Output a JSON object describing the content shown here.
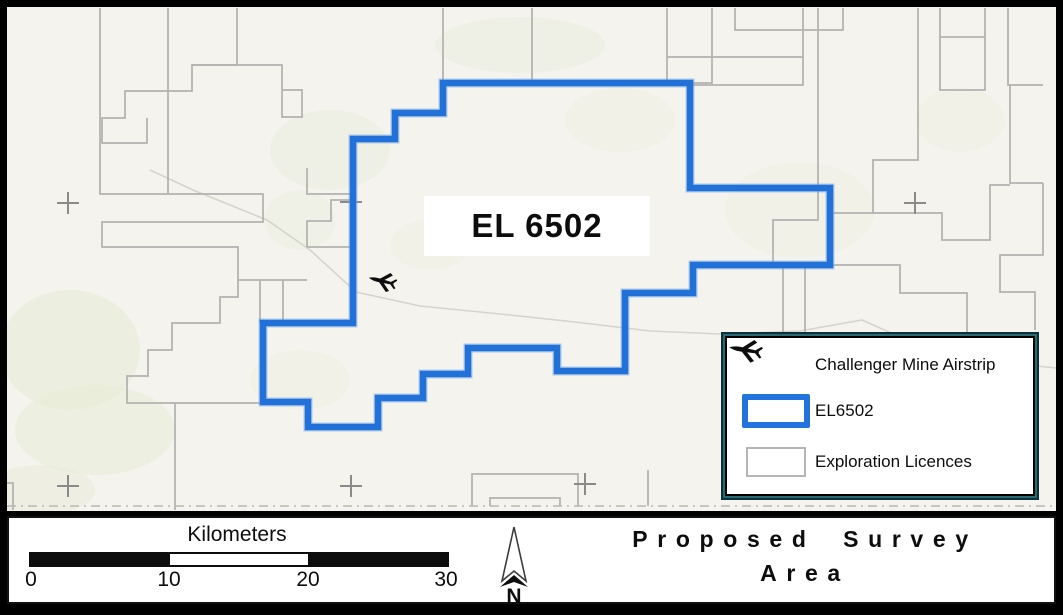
{
  "map": {
    "el_label": "EL 6502",
    "colors": {
      "background": "#f4f3ee",
      "el6502_stroke": "#2171d9",
      "el6502_halo": "#74a8e8",
      "licence_stroke": "#b3b3b1",
      "road_stroke": "#d5d4cd",
      "cross_stroke": "#8a8a8a",
      "dashed_stroke": "#b9b8b2",
      "vegetation_fill": "#e6ebd3"
    },
    "el6502_polygon": [
      [
        443,
        83
      ],
      [
        690,
        83
      ],
      [
        690,
        188
      ],
      [
        830,
        188
      ],
      [
        830,
        265
      ],
      [
        693,
        265
      ],
      [
        693,
        293
      ],
      [
        625,
        293
      ],
      [
        625,
        371
      ],
      [
        557,
        371
      ],
      [
        557,
        348
      ],
      [
        468,
        348
      ],
      [
        468,
        374
      ],
      [
        423,
        374
      ],
      [
        423,
        398
      ],
      [
        378,
        398
      ],
      [
        378,
        427
      ],
      [
        308,
        427
      ],
      [
        308,
        402
      ],
      [
        263,
        402
      ],
      [
        263,
        323
      ],
      [
        353,
        323
      ],
      [
        353,
        139
      ],
      [
        395,
        139
      ],
      [
        395,
        113
      ],
      [
        443,
        113
      ]
    ],
    "airstrip_marker": {
      "x": 382,
      "y": 281,
      "rotation": 14,
      "scale": 0.85
    },
    "licence_paths": [
      [
        [
          100,
          8
        ],
        [
          100,
          194
        ],
        [
          263,
          194
        ],
        [
          263,
          222
        ],
        [
          102,
          222
        ],
        [
          102,
          247
        ],
        [
          238,
          247
        ],
        [
          238,
          297
        ],
        [
          220,
          297
        ],
        [
          220,
          323
        ],
        [
          172,
          323
        ],
        [
          172,
          350
        ],
        [
          148,
          350
        ],
        [
          148,
          376
        ],
        [
          127,
          376
        ],
        [
          127,
          403
        ],
        [
          260,
          403
        ]
      ],
      [
        [
          175,
          403
        ],
        [
          175,
          510
        ]
      ],
      [
        [
          6,
          483
        ],
        [
          13,
          483
        ],
        [
          13,
          510
        ]
      ],
      [
        [
          168,
          8
        ],
        [
          168,
          194
        ]
      ],
      [
        [
          237,
          8
        ],
        [
          237,
          65
        ],
        [
          192,
          65
        ],
        [
          192,
          91
        ],
        [
          125,
          91
        ],
        [
          125,
          118
        ],
        [
          102,
          118
        ],
        [
          102,
          143
        ],
        [
          147,
          143
        ],
        [
          147,
          118
        ]
      ],
      [
        [
          192,
          65
        ],
        [
          282,
          65
        ],
        [
          282,
          117
        ],
        [
          302,
          117
        ],
        [
          302,
          90
        ],
        [
          282,
          90
        ]
      ],
      [
        [
          443,
          8
        ],
        [
          443,
          83
        ]
      ],
      [
        [
          532,
          8
        ],
        [
          532,
          83
        ]
      ],
      [
        [
          667,
          8
        ],
        [
          667,
          83
        ]
      ],
      [
        [
          667,
          57
        ],
        [
          803,
          57
        ],
        [
          803,
          8
        ]
      ],
      [
        [
          667,
          85
        ],
        [
          803,
          85
        ],
        [
          803,
          57
        ]
      ],
      [
        [
          712,
          8
        ],
        [
          712,
          83
        ],
        [
          690,
          83
        ]
      ],
      [
        [
          735,
          8
        ],
        [
          735,
          30
        ],
        [
          843,
          30
        ],
        [
          843,
          8
        ]
      ],
      [
        [
          940,
          8
        ],
        [
          940,
          90
        ],
        [
          985,
          90
        ],
        [
          985,
          8
        ]
      ],
      [
        [
          940,
          37
        ],
        [
          985,
          37
        ]
      ],
      [
        [
          1008,
          8
        ],
        [
          1008,
          85
        ],
        [
          1043,
          85
        ]
      ],
      [
        [
          918,
          8
        ],
        [
          918,
          160
        ],
        [
          873,
          160
        ],
        [
          873,
          213
        ],
        [
          830,
          213
        ]
      ],
      [
        [
          873,
          213
        ],
        [
          942,
          213
        ],
        [
          942,
          240
        ],
        [
          990,
          240
        ],
        [
          990,
          185
        ],
        [
          1010,
          185
        ]
      ],
      [
        [
          1010,
          85
        ],
        [
          1010,
          183
        ],
        [
          1043,
          183
        ]
      ],
      [
        [
          1043,
          183
        ],
        [
          1043,
          255
        ],
        [
          1000,
          255
        ],
        [
          1000,
          292
        ],
        [
          1035,
          292
        ],
        [
          1035,
          330
        ]
      ],
      [
        [
          830,
          265
        ],
        [
          900,
          265
        ],
        [
          900,
          293
        ],
        [
          967,
          293
        ],
        [
          967,
          340
        ]
      ],
      [
        [
          783,
          265
        ],
        [
          783,
          335
        ]
      ],
      [
        [
          805,
          265
        ],
        [
          805,
          335
        ]
      ],
      [
        [
          818,
          8
        ],
        [
          818,
          220
        ],
        [
          773,
          220
        ],
        [
          773,
          265
        ]
      ],
      [
        [
          307,
          247
        ],
        [
          307,
          221
        ],
        [
          331,
          221
        ],
        [
          331,
          200
        ],
        [
          353,
          200
        ]
      ],
      [
        [
          307,
          247
        ],
        [
          353,
          247
        ]
      ],
      [
        [
          353,
          194
        ],
        [
          307,
          194
        ],
        [
          307,
          168
        ]
      ],
      [
        [
          238,
          280
        ],
        [
          307,
          280
        ]
      ],
      [
        [
          260,
          280
        ],
        [
          260,
          323
        ]
      ],
      [
        [
          283,
          280
        ],
        [
          283,
          323
        ]
      ],
      [
        [
          472,
          506
        ],
        [
          472,
          474
        ],
        [
          578,
          474
        ],
        [
          578,
          506
        ]
      ],
      [
        [
          490,
          506
        ],
        [
          490,
          498
        ],
        [
          560,
          498
        ],
        [
          560,
          506
        ]
      ],
      [
        [
          648,
          470
        ],
        [
          648,
          506
        ]
      ]
    ],
    "roads": [
      [
        [
          150,
          170
        ],
        [
          193,
          190
        ],
        [
          267,
          220
        ],
        [
          310,
          250
        ],
        [
          356,
          292
        ],
        [
          420,
          306
        ],
        [
          500,
          314
        ],
        [
          575,
          322
        ],
        [
          650,
          331
        ],
        [
          720,
          334
        ],
        [
          800,
          331
        ],
        [
          862,
          320
        ],
        [
          920,
          346
        ],
        [
          1000,
          362
        ],
        [
          1056,
          368
        ]
      ]
    ],
    "graticule_crosses": [
      [
        68,
        203
      ],
      [
        351,
        202
      ],
      [
        915,
        203
      ],
      [
        68,
        486
      ],
      [
        351,
        486
      ],
      [
        585,
        484
      ]
    ],
    "dashed_line_y": 506,
    "vegetation_patches": [
      {
        "cx": 70,
        "cy": 350,
        "rx": 70,
        "ry": 60,
        "o": 0.55
      },
      {
        "cx": 95,
        "cy": 430,
        "rx": 80,
        "ry": 45,
        "o": 0.5
      },
      {
        "cx": 40,
        "cy": 490,
        "rx": 55,
        "ry": 25,
        "o": 0.45
      },
      {
        "cx": 330,
        "cy": 150,
        "rx": 60,
        "ry": 40,
        "o": 0.35
      },
      {
        "cx": 300,
        "cy": 220,
        "rx": 35,
        "ry": 30,
        "o": 0.3
      },
      {
        "cx": 520,
        "cy": 45,
        "rx": 85,
        "ry": 28,
        "o": 0.35
      },
      {
        "cx": 620,
        "cy": 120,
        "rx": 55,
        "ry": 32,
        "o": 0.25
      },
      {
        "cx": 800,
        "cy": 210,
        "rx": 75,
        "ry": 48,
        "o": 0.2
      },
      {
        "cx": 430,
        "cy": 245,
        "rx": 40,
        "ry": 25,
        "o": 0.2
      },
      {
        "cx": 300,
        "cy": 380,
        "rx": 50,
        "ry": 30,
        "o": 0.25
      },
      {
        "cx": 960,
        "cy": 120,
        "rx": 45,
        "ry": 32,
        "o": 0.2
      }
    ]
  },
  "legend": {
    "items": [
      {
        "icon": "airplane-icon",
        "label": "Challenger Mine Airstrip"
      },
      {
        "icon": "el6502-swatch",
        "label": "EL6502"
      },
      {
        "icon": "licence-swatch",
        "label": "Exploration Licences"
      }
    ]
  },
  "scalebar": {
    "title": "Kilometers",
    "ticks": [
      "0",
      "10",
      "20",
      "30"
    ],
    "segment_colors": [
      "#0d0d0d",
      "#ffffff",
      "#0d0d0d"
    ]
  },
  "north_arrow": {
    "label": "N"
  },
  "title": {
    "line1": "Proposed Survey",
    "line2": "Area"
  }
}
